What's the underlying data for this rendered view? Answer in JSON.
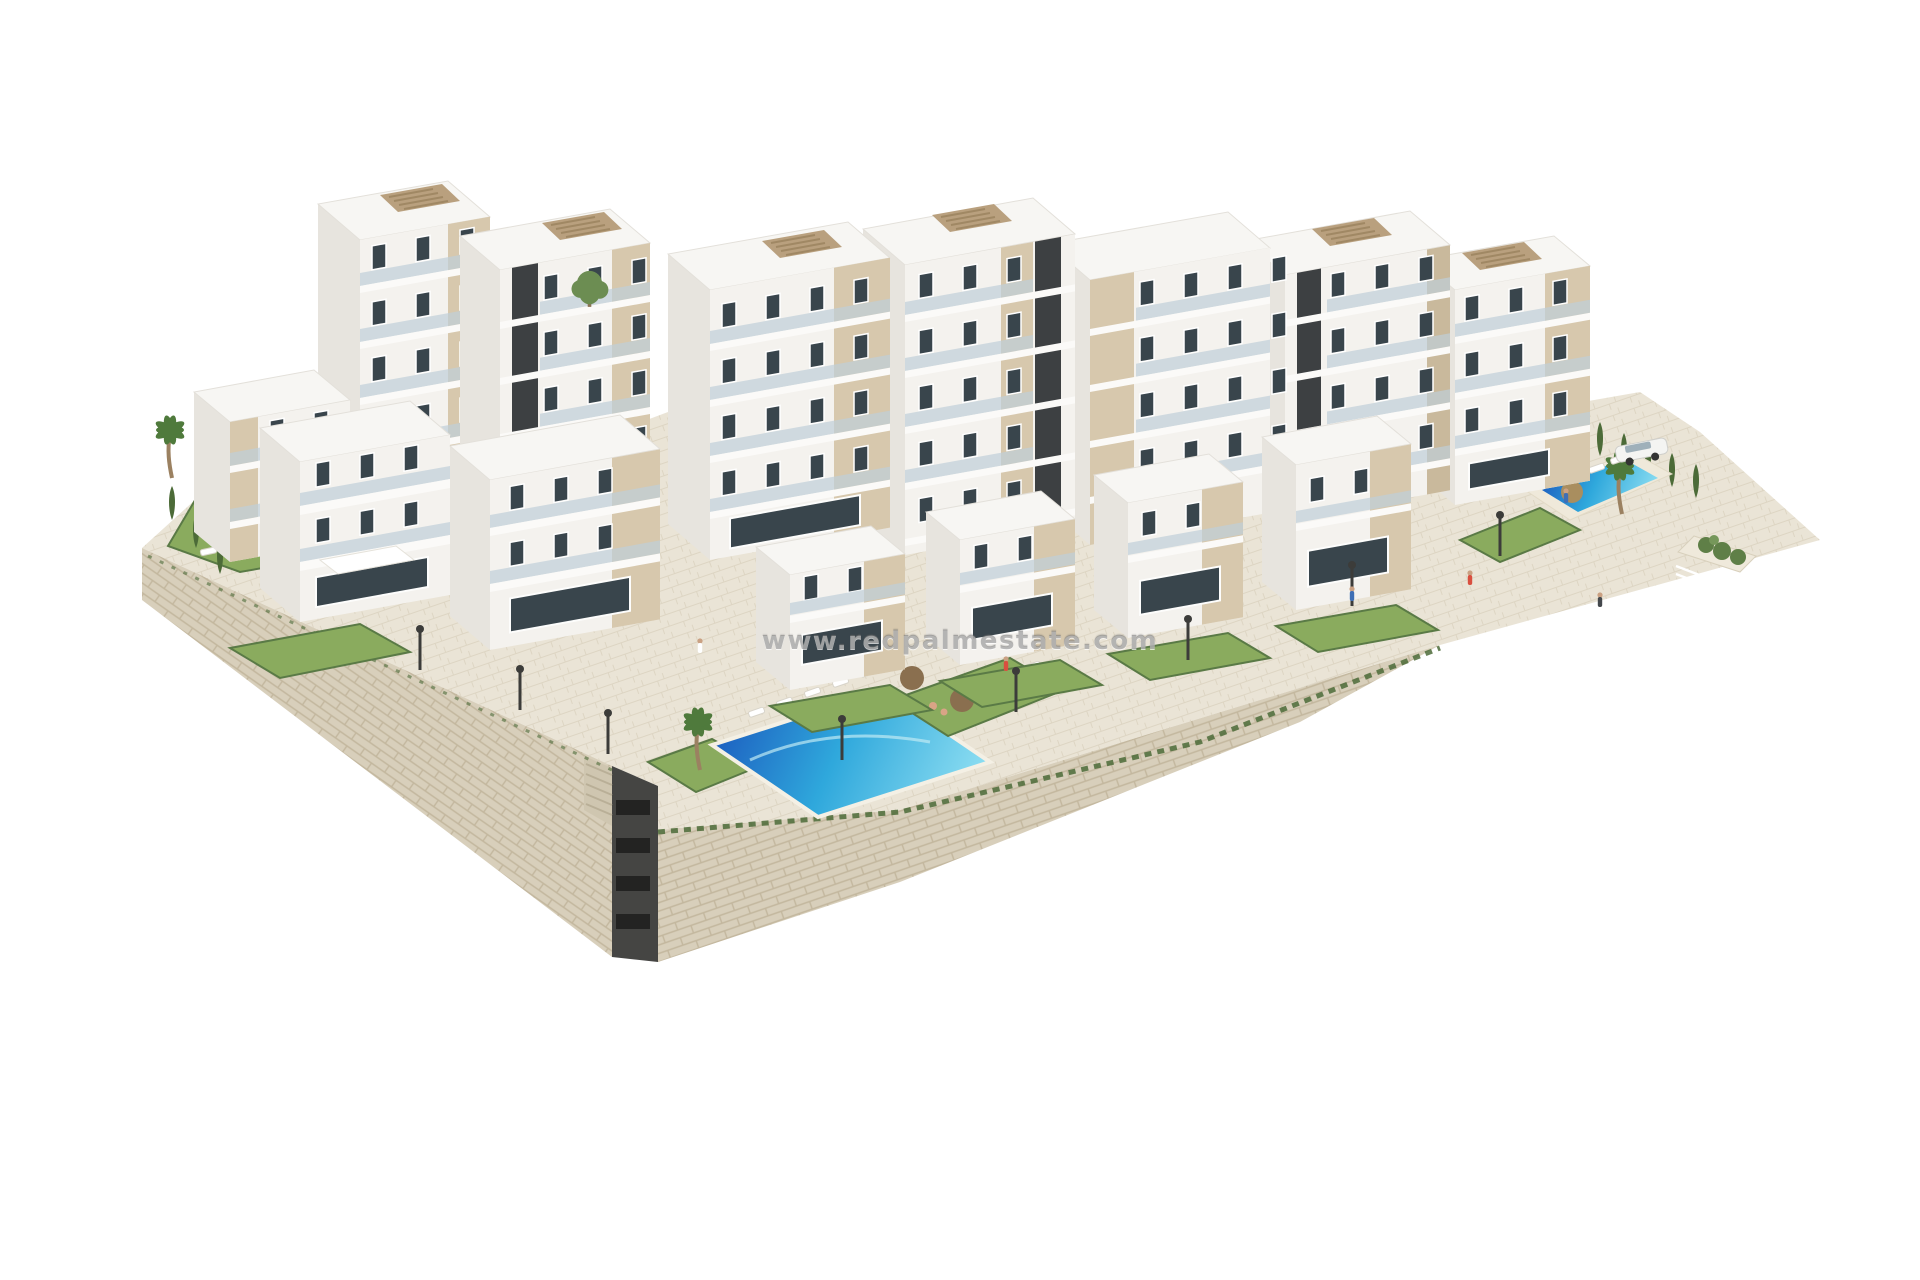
{
  "scene": {
    "description": "Photorealistic aerial 3D render of a terraced hillside apartment complex with communal swimming pools, gardens and a stone retaining wall, isolated on a white background",
    "style": "architectural visualization"
  },
  "watermark": {
    "text": "www.redpalmestate.com"
  },
  "palette": {
    "background": "#ffffff",
    "building_white": "#f4f2ee",
    "building_side": "#e7e4de",
    "building_roof": "#f7f6f3",
    "floor_slab": "#fbfaf8",
    "accent_beige": "#d7c8ad",
    "accent_beige_dark": "#c9b99c",
    "dark_core": "#3d4042",
    "window_glass": "#39454c",
    "balcony_glass": "#bfcfd8",
    "lawn": "#8aab5e",
    "hedge": "#4c6b38",
    "palm_frond": "#4f7a3c",
    "pool_deep": "#1d5fc0",
    "pool_mid": "#2fa8dc",
    "pool_light": "#8fdff2",
    "stone": "#d8cfbb",
    "stone_line": "#c3b79e",
    "paving": "#eae4d6",
    "pergola": "#b9a07e",
    "parasol": "#8a6f4f",
    "straw_parasol": "#a98e5f"
  },
  "inventory": {
    "apartment_blocks": 10,
    "terraced_villas": 4,
    "swimming_pools": 3,
    "palm_trees": 3,
    "street_lamps": 8,
    "cars": 1
  }
}
